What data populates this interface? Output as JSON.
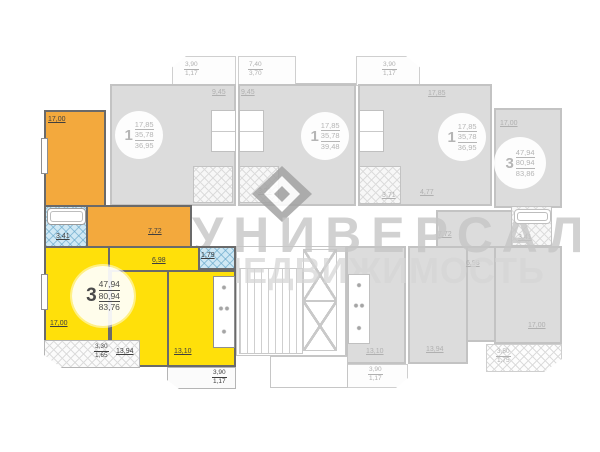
{
  "watermark": {
    "line1": "УНИВЕРСАЛ",
    "line2": "НЕДВИЖИМОСТЬ"
  },
  "colors": {
    "highlight_orange": "#F3A93D",
    "highlight_yellow": "#FFE00A",
    "gray_fill": "#DCDCDC",
    "hatch_blue": "#CFE8F4"
  },
  "apartments": {
    "highlighted": {
      "badge": {
        "rooms": "3",
        "living": "47,94",
        "area": "80,94",
        "total": "83,76"
      },
      "labels": {
        "room_top": "17,00",
        "bath": "3,41",
        "hall": "7,72",
        "room_badge": "17,00",
        "room_mid": "13,94",
        "kitchen": "13,10",
        "wc": "1,79",
        "corridor": "6,98"
      },
      "balcony_left": {
        "full": "3,30",
        "reduced": "1,65"
      },
      "balcony_bottom": {
        "full": "3,90",
        "reduced": "1,17"
      }
    },
    "one_room_left": {
      "badge": {
        "rooms": "1",
        "living": "17,85",
        "area": "35,78",
        "total": "36,95"
      },
      "kitchen": "9,45",
      "balcony": {
        "full": "3,90",
        "reduced": "1,17"
      }
    },
    "one_room_center": {
      "badge": {
        "rooms": "1",
        "living": "17,85",
        "area": "35,78",
        "total": "39,48"
      },
      "kitchen": "9,45",
      "bath": "3,71",
      "balcony": {
        "full": "7,40",
        "reduced": "3,70"
      }
    },
    "one_room_right": {
      "badge": {
        "rooms": "1",
        "living": "17,85",
        "area": "35,78",
        "total": "36,95"
      },
      "room": "17,85",
      "bath": "3,71",
      "hall": "4,77",
      "balcony": {
        "full": "3,90",
        "reduced": "1,17"
      }
    },
    "three_room_right": {
      "badge": {
        "rooms": "3",
        "living": "47,94",
        "area": "80,94",
        "total": "83,86"
      },
      "labels": {
        "room_top": "17,00",
        "bath": "3,41",
        "hall": "7,72",
        "corridor": "6,98",
        "room_bottom": "17,00",
        "room_mid": "13,94",
        "kitchen": "13,10"
      },
      "balcony_side": {
        "full": "3,50",
        "reduced": "1,75"
      },
      "balcony_bottom": {
        "full": "3,90",
        "reduced": "1,17"
      }
    }
  }
}
